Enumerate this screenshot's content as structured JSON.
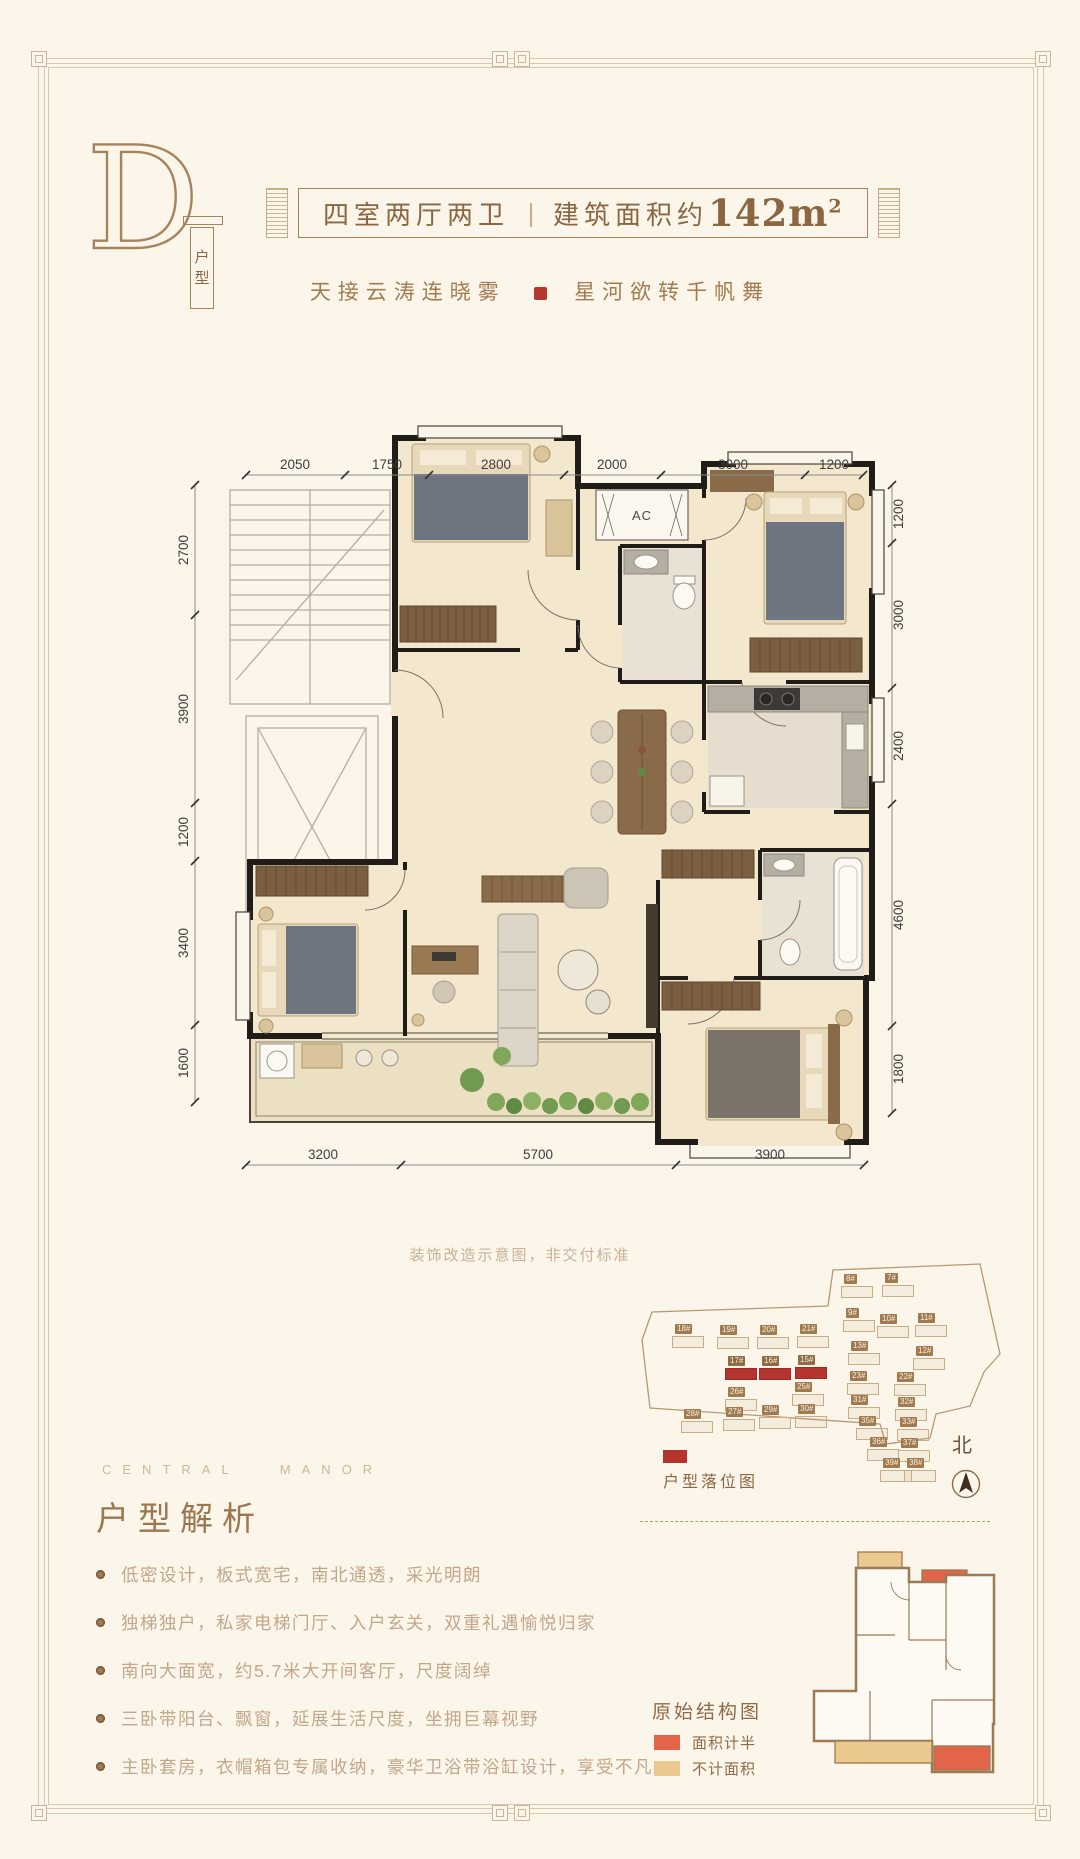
{
  "colors": {
    "background": "#fbf5ea",
    "accent_brown": "#8a6742",
    "seal_red": "#b23830",
    "wall_dark": "#201c17",
    "floor_cream": "#f3e7ce",
    "highlight_red": "#b5342f",
    "structure_half_red": "#e2654a",
    "structure_excluded_tan": "#eac88e"
  },
  "header": {
    "unit_letter": "D",
    "unit_type_vertical": [
      "户",
      "型"
    ],
    "banner_rooms": "四室两厅两卫",
    "banner_divider": "｜",
    "banner_area_prefix": "建筑面积约",
    "banner_area_value": "142m",
    "banner_area_sup": "2",
    "tagline_left": "天接云涛连晓雾",
    "tagline_right": "星河欲转千帆舞"
  },
  "floor_plan": {
    "ac_label": "AC",
    "note": "装饰改造示意图，非交付标准",
    "dims_top": [
      "2050",
      "1750",
      "2800",
      "2000",
      "3000",
      "1200"
    ],
    "dims_left": [
      "2700",
      "3900",
      "1200",
      "3400",
      "1600"
    ],
    "dims_right": [
      "1200",
      "3000",
      "2400",
      "4600",
      "1800"
    ],
    "dims_bottom": [
      "3200",
      "5700",
      "3900"
    ]
  },
  "site_plan": {
    "legend_label": "户型落位图",
    "north_label": "北",
    "buildings": [
      {
        "label": "8#",
        "x": 216,
        "y": 18,
        "hl": false
      },
      {
        "label": "7#",
        "x": 257,
        "y": 17,
        "hl": false
      },
      {
        "label": "9#",
        "x": 218,
        "y": 52,
        "hl": false
      },
      {
        "label": "10#",
        "x": 252,
        "y": 58,
        "hl": false
      },
      {
        "label": "11#",
        "x": 290,
        "y": 57,
        "hl": false
      },
      {
        "label": "18#",
        "x": 47,
        "y": 68,
        "hl": false
      },
      {
        "label": "19#",
        "x": 92,
        "y": 69,
        "hl": false
      },
      {
        "label": "20#",
        "x": 132,
        "y": 69,
        "hl": false
      },
      {
        "label": "21#",
        "x": 172,
        "y": 68,
        "hl": false
      },
      {
        "label": "13#",
        "x": 223,
        "y": 85,
        "hl": false
      },
      {
        "label": "12#",
        "x": 288,
        "y": 90,
        "hl": false
      },
      {
        "label": "17#",
        "x": 100,
        "y": 100,
        "hl": true
      },
      {
        "label": "16#",
        "x": 134,
        "y": 100,
        "hl": true
      },
      {
        "label": "15#",
        "x": 170,
        "y": 99,
        "hl": true
      },
      {
        "label": "23#",
        "x": 222,
        "y": 115,
        "hl": false
      },
      {
        "label": "22#",
        "x": 269,
        "y": 116,
        "hl": false
      },
      {
        "label": "26#",
        "x": 100,
        "y": 131,
        "hl": false
      },
      {
        "label": "25#",
        "x": 167,
        "y": 126,
        "hl": false
      },
      {
        "label": "31#",
        "x": 223,
        "y": 139,
        "hl": false
      },
      {
        "label": "32#",
        "x": 270,
        "y": 141,
        "hl": false
      },
      {
        "label": "28#",
        "x": 56,
        "y": 153,
        "hl": false
      },
      {
        "label": "27#",
        "x": 98,
        "y": 151,
        "hl": false
      },
      {
        "label": "29#",
        "x": 134,
        "y": 149,
        "hl": false
      },
      {
        "label": "30#",
        "x": 170,
        "y": 148,
        "hl": false
      },
      {
        "label": "35#",
        "x": 231,
        "y": 160,
        "hl": false
      },
      {
        "label": "33#",
        "x": 272,
        "y": 161,
        "hl": false
      },
      {
        "label": "36#",
        "x": 242,
        "y": 181,
        "hl": false
      },
      {
        "label": "37#",
        "x": 273,
        "y": 182,
        "hl": false
      },
      {
        "label": "39#",
        "x": 255,
        "y": 202,
        "hl": false
      },
      {
        "label": "38#",
        "x": 279,
        "y": 202,
        "hl": false
      }
    ]
  },
  "analysis": {
    "eyebrow": "CENTRAL MANOR",
    "title": "户型解析",
    "bullets": [
      "低密设计，板式宽宅，南北通透，采光明朗",
      "独梯独户，私家电梯门厅、入户玄关，双重礼遇愉悦归家",
      "南向大面宽，约5.7米大开间客厅，尺度阔绰",
      "三卧带阳台、飘窗，延展生活尺度，坐拥巨幕视野",
      "主卧套房，衣帽箱包专属收纳，豪华卫浴带浴缸设计，享受不凡"
    ]
  },
  "structure": {
    "title": "原始结构图",
    "legend_half": "面积计半",
    "legend_excluded": "不计面积",
    "half_color": "#e2654a",
    "excluded_color": "#eac88e"
  }
}
